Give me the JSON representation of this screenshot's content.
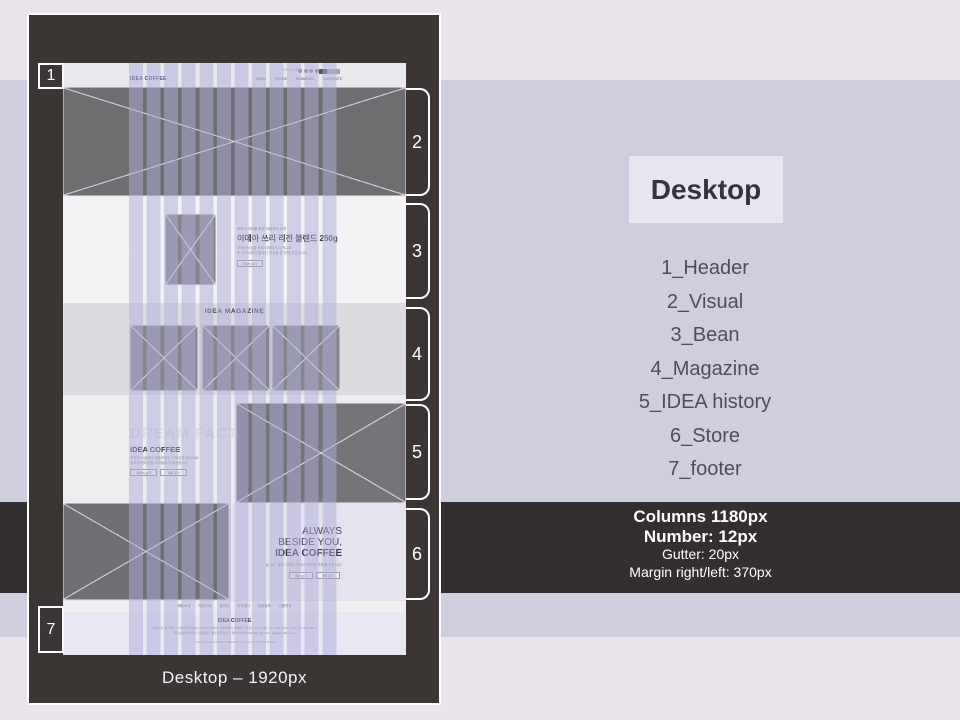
{
  "markers": [
    "1",
    "2",
    "3",
    "4",
    "5",
    "6",
    "7"
  ],
  "panel": {
    "caption": "Desktop – 1920px"
  },
  "wf": {
    "header": {
      "logo": "IDEA COFFEE",
      "util": "LOGIN JOIN",
      "nav": [
        "MENU",
        "STORE",
        "REWARDS",
        "CONTENTS"
      ]
    },
    "bean": {
      "tagline": "커피의 미래를 위한 이데아의 노력",
      "title": "이데아 쓰리 리전 블렌드 250g",
      "body1": "이데아농장을 위해 이데아의 노력으로",
      "body2": "또 이겨내며 관찰하던 정성을 한 잔에 담았습니다.",
      "button": "자세히 보기"
    },
    "magazine": {
      "title": "IDEA MAGAZINE"
    },
    "history": {
      "ghost": "DREAM FACTORY",
      "title": "IDEA COFFEE",
      "body1": "최선의 시설에서 만들어지는 신뢰성과 정성으로",
      "body2": "최고의 커피맛을 고객들에게 제공합니다.",
      "btn1": "자세히 보기",
      "btn2": "매장 찾기"
    },
    "store": {
      "line1": "ALWAYS",
      "line2": "BESIDE YOU,",
      "line3": "IDEA COFFEE",
      "body": "늘 당신 곁에, 이데아 커피가 따뜻한 하루를 전합니다.",
      "btn1": "메뉴 보기",
      "btn2": "매장 찾기"
    },
    "footnav": [
      "제품소개",
      "매장안내",
      "멤버십",
      "고객센터",
      "채용정보",
      "이용약관"
    ],
    "footer": {
      "logo": "IDEA COFFEE",
      "line1": "대표이사 김이데아 | 사업자등록번호 123-45-67890 | 서울특별시 이데아구 커피로 123 | TEL. 02-1234-5678 | FAX. 02-1234-5679",
      "line2": "개인정보처리방침 | 이용약관 | 통신판매업신고 제2023-서울-0000호 | E-MAIL. idea@coffee.com",
      "copyright": "© 2023 IDEA COFFEE COMPANY. ALL RIGHTS RESERVED."
    }
  },
  "right": {
    "title": "Desktop",
    "sections": [
      "1_Header",
      "2_Visual",
      "3_Bean",
      "4_Magazine",
      "5_IDEA history",
      "6_Store",
      "7_footer"
    ]
  },
  "specs": {
    "columns": "Columns 1180px",
    "number": "Number: 12px",
    "gutter": "Gutter: 20px",
    "margin": "Margin right/left: 370px"
  },
  "colors": {
    "panel": "#3b3634",
    "dark_band": "#332f30",
    "bg_light": "#e8e4e9",
    "bg_mid": "#cfcede",
    "column_overlay": "rgba(173,173,221,0.5)"
  }
}
